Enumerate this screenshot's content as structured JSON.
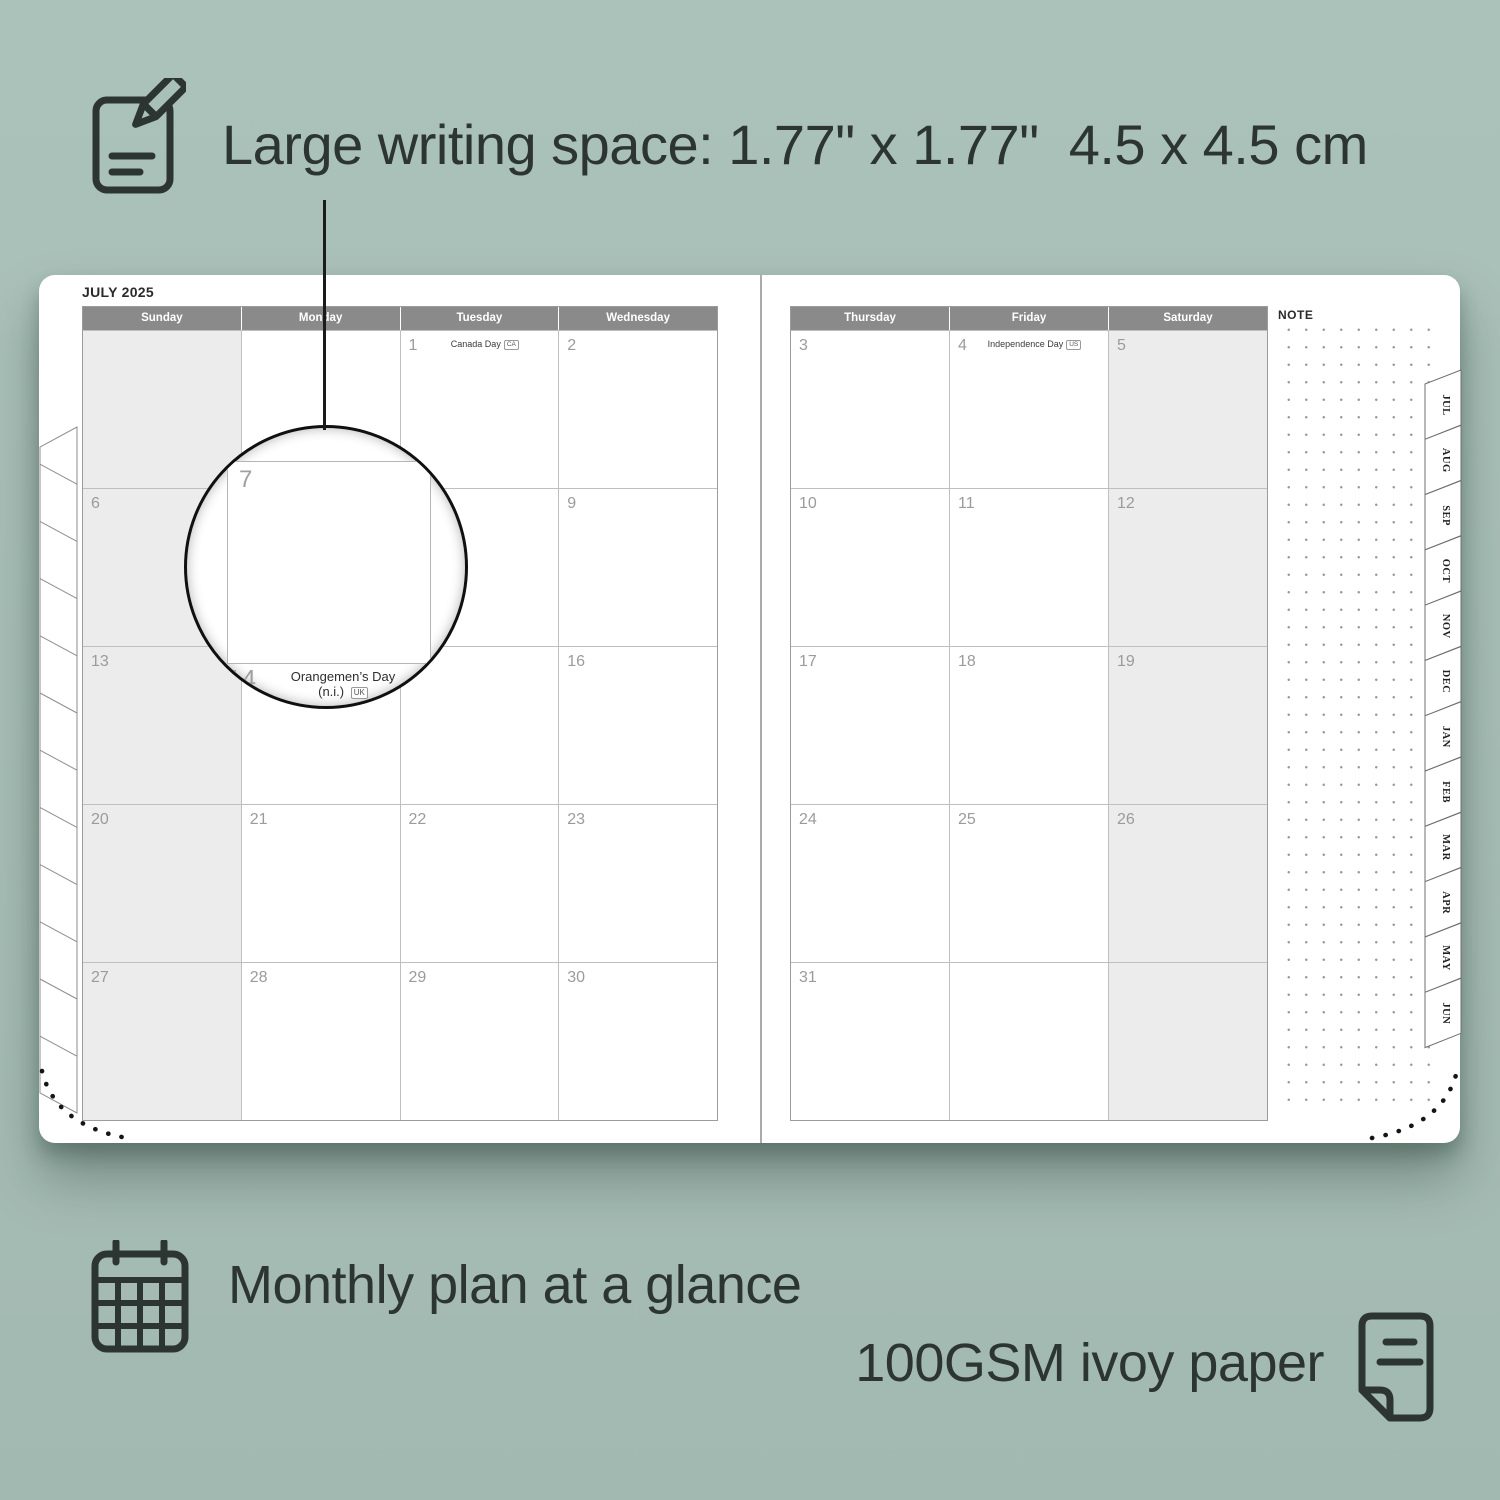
{
  "annotations": {
    "top_label": "Large writing space: 1.77\" x 1.77\"  4.5 x 4.5 cm",
    "bottom_left_label": "Monthly plan at a glance",
    "bottom_right_label": "100GSM ivoy paper"
  },
  "icons": [
    "pencil-note-icon",
    "calendar-grid-icon",
    "paper-sheet-icon"
  ],
  "planner": {
    "title": "JULY 2025",
    "note_label": "NOTE",
    "left_page": {
      "day_headers": [
        "Sunday",
        "Monday",
        "Tuesday",
        "Wednesday"
      ],
      "weekend_column": 0,
      "rows": [
        [
          "",
          "",
          "1",
          "2"
        ],
        [
          "6",
          "7",
          "8",
          "9"
        ],
        [
          "13",
          "14",
          "15",
          "16"
        ],
        [
          "20",
          "21",
          "22",
          "23"
        ],
        [
          "27",
          "28",
          "29",
          "30"
        ]
      ]
    },
    "right_page": {
      "day_headers": [
        "Thursday",
        "Friday",
        "Saturday"
      ],
      "weekend_column": 2,
      "rows": [
        [
          "3",
          "4",
          "5"
        ],
        [
          "10",
          "11",
          "12"
        ],
        [
          "17",
          "18",
          "19"
        ],
        [
          "24",
          "25",
          "26"
        ],
        [
          "31",
          "",
          ""
        ]
      ]
    },
    "holidays": {
      "1": {
        "name": "Canada Day",
        "region": "CA"
      },
      "4": {
        "name": "Independence Day",
        "region": "US"
      },
      "14": {
        "name": "Orangemen’s Day (n.i.)",
        "region": "UK"
      }
    },
    "month_tabs": [
      "JUL",
      "AUG",
      "SEP",
      "OCT",
      "NOV",
      "DEC",
      "JAN",
      "FEB",
      "MAR",
      "APR",
      "MAY",
      "JUN"
    ],
    "magnifier": {
      "day": "7",
      "next_day": "14",
      "holiday_name": "Orangemen’s Day",
      "holiday_suffix": "(n.i.)",
      "holiday_region": "UK"
    }
  },
  "colors": {
    "background": "#a7beb6",
    "ink": "#2c3531",
    "header_bg": "#8a8a8a",
    "weekend_bg": "#ececec",
    "grid_line": "#bfbfbf",
    "day_number": "#9b9b9b"
  }
}
